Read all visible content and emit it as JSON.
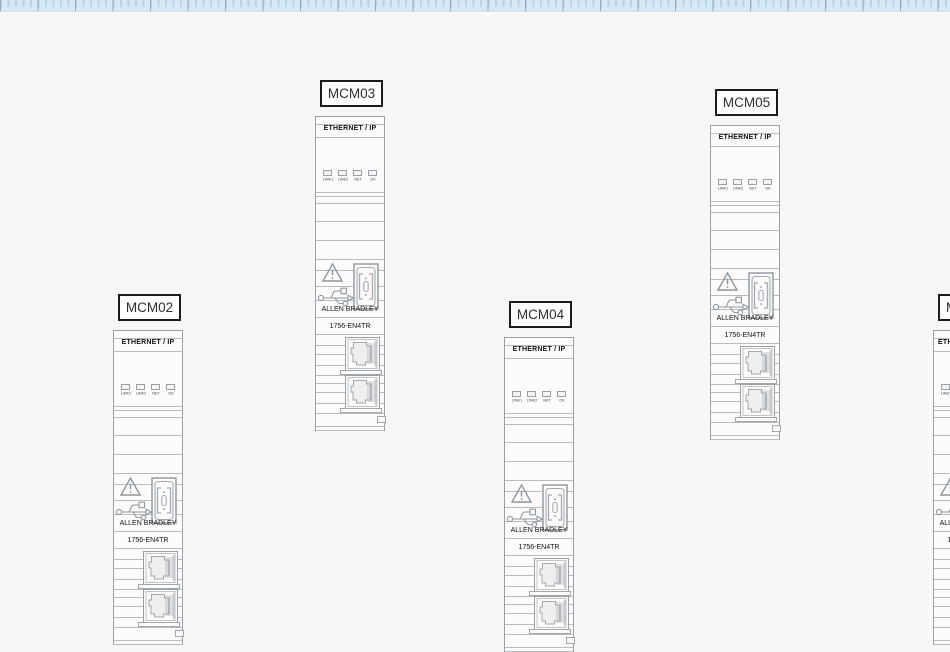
{
  "colors": {
    "background": "#f7f7f8",
    "ruler_band": "#d8e9f6",
    "ruler_tick_minor": "#b9d3e7",
    "ruler_tick_major": "#92a9bc",
    "module_outline": "#9ba1a7",
    "label_border": "#1c1c1c"
  },
  "module_common": {
    "header": "ETHERNET / IP",
    "led_labels": [
      "LINK1",
      "LINK2",
      "NET",
      "OK"
    ],
    "brand": "ALLEN BRADLEY",
    "model": "1756-EN4TR",
    "icons": [
      "warning-triangle-icon",
      "usb-icon",
      "module-door-icon",
      "ethernet-jack-icon"
    ]
  },
  "modules": [
    {
      "label": "MCM02",
      "x": 113,
      "y": 306
    },
    {
      "label": "MCM03",
      "x": 315,
      "y": 92
    },
    {
      "label": "MCM04",
      "x": 504,
      "y": 313
    },
    {
      "label": "MCM05",
      "x": 710,
      "y": 101
    },
    {
      "label": "M",
      "x": 933,
      "y": 306,
      "clipped": true
    }
  ]
}
